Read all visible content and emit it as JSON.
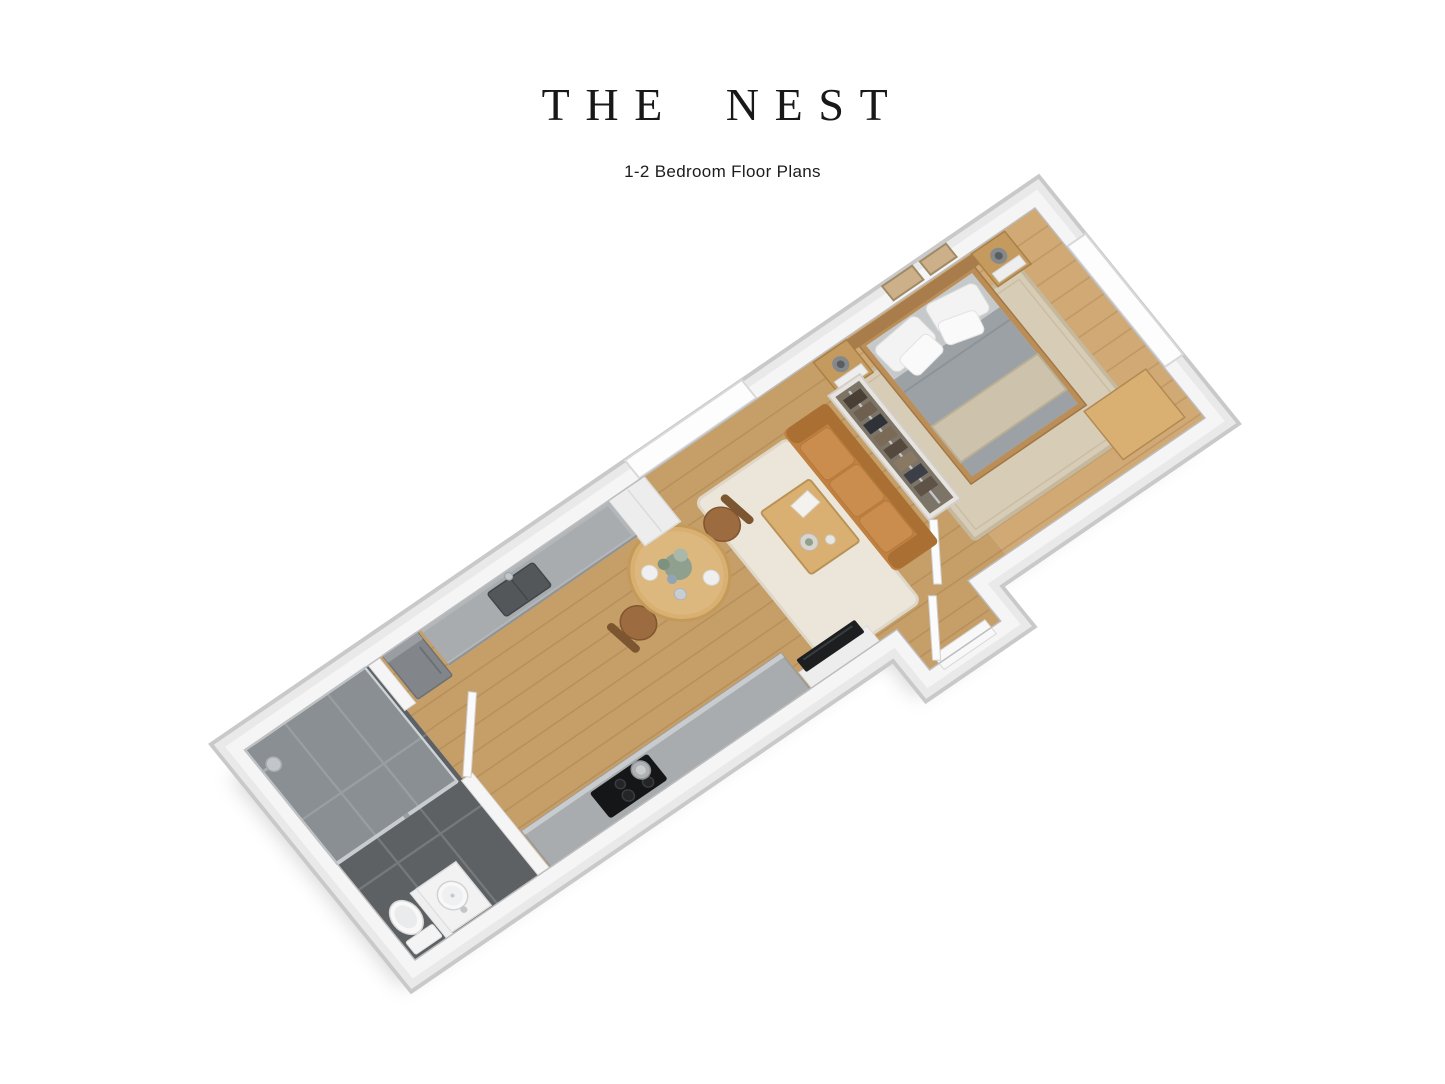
{
  "header": {
    "title": "THE NEST",
    "subtitle": "1-2 Bedroom Floor Plans"
  },
  "floor_plan": {
    "description": "3D isometric render of a long narrow 1-2 bedroom apartment, rotated diagonally",
    "rooms": [
      {
        "name": "bedroom",
        "furniture": [
          "double-bed",
          "two-nightstands",
          "two-table-lamps",
          "two-wall-art-frames",
          "area-rug",
          "desk",
          "window"
        ]
      },
      {
        "name": "living-room",
        "furniture": [
          "open-wardrobe",
          "caramel-sofa",
          "coffee-table",
          "shag-rug",
          "tv-on-white-unit",
          "window",
          "entry-door"
        ]
      },
      {
        "name": "dining-area",
        "furniture": [
          "round-table",
          "two-chairs",
          "flower-vase"
        ]
      },
      {
        "name": "kitchen",
        "furniture": [
          "counter-with-sink",
          "tall-cabinet",
          "fridge",
          "island-counter",
          "cooktop",
          "pot"
        ]
      },
      {
        "name": "bathroom",
        "furniture": [
          "glass-shower",
          "toilet",
          "round-basin-counter",
          "dark-tile-floor"
        ]
      }
    ],
    "palette": {
      "wall": "#f5f5f5",
      "wall_mid": "#e9e9e9",
      "wall_dark": "#c9c9c9",
      "wood": "#c59e68",
      "wood_light": "#d0a974",
      "tile": "#5d6164",
      "grout": "#75797c",
      "rug_bedroom": "#d7ccb6",
      "rug_living": "#ece6da",
      "sofa": "#c08040",
      "sofa_dark": "#a96f33",
      "cushion": "#cb8d4d",
      "table_wood": "#d9b072",
      "chair_brown": "#9c6b3f",
      "chair_back": "#7b5630",
      "bed_frame": "#bb8d57",
      "headboard": "#a87c4b",
      "mattress": "#c6c9ca",
      "duvet": "#9ba1a4",
      "throw": "#cdc3ac",
      "nightstand": "#c49a5e",
      "counter_top": "#a8acae",
      "counter_edge": "#b4b7b9",
      "sink_dark": "#53575a",
      "cooktop": "#151617",
      "fridge": "#82868a",
      "tv": "#1c1e20",
      "cabinet_white": "#ededed",
      "glass": "#dce4e8",
      "porcelain": "#f8f8f8",
      "chrome": "#c2c6ca",
      "wardrobe_interior": "#7d7468",
      "wall_art": "#cbb089",
      "shadow": "rgba(0,0,0,0.15)"
    }
  }
}
